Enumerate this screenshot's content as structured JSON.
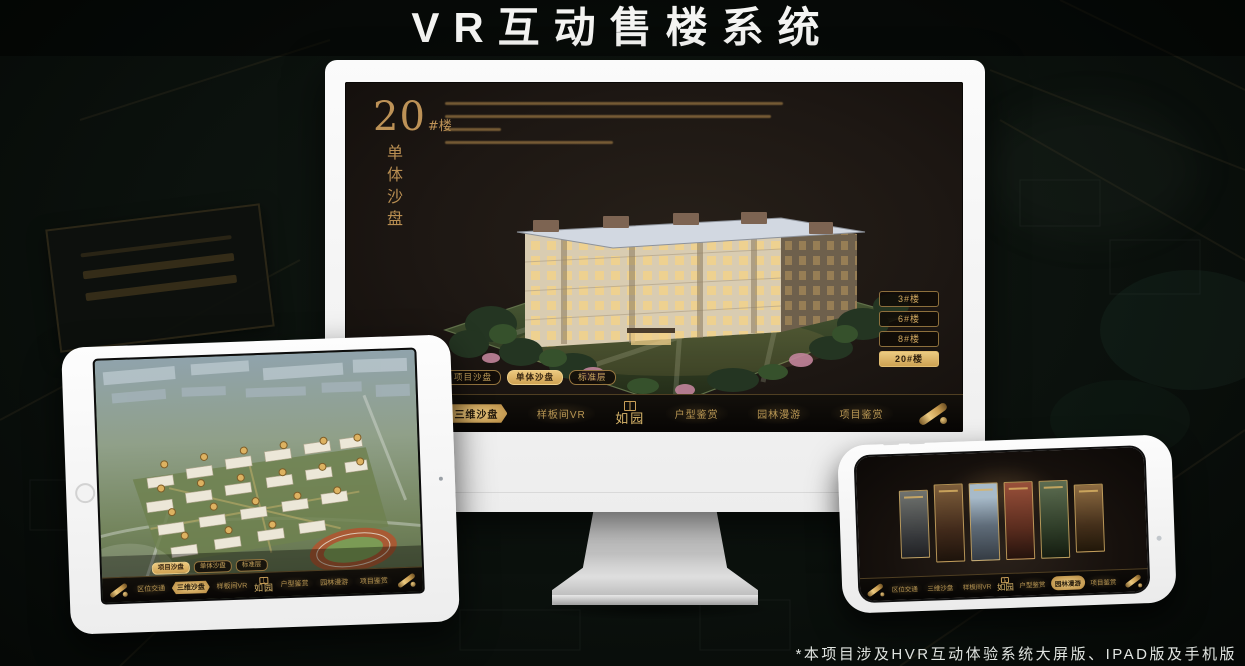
{
  "page": {
    "title": "VR互动售楼系统",
    "footnote": "*本项目涉及HVR互动体验系统大屏版、IPAD版及手机版"
  },
  "colors": {
    "gold_accent": "#c9a05c",
    "gold_selected": "#ecca81",
    "screen_background": "#1d1713",
    "page_background": "#0b110d"
  },
  "monitor": {
    "panel_title": {
      "number": "20",
      "suffix": "#楼",
      "vertical_label": "单体沙盘"
    },
    "building_buttons": [
      {
        "label": "3#楼",
        "selected": false
      },
      {
        "label": "6#楼",
        "selected": false
      },
      {
        "label": "8#楼",
        "selected": false
      },
      {
        "label": "20#楼",
        "selected": true
      }
    ],
    "sub_tabs": [
      {
        "label": "项目沙盘",
        "selected": false
      },
      {
        "label": "单体沙盘",
        "selected": true
      },
      {
        "label": "标准层",
        "selected": false
      }
    ],
    "menu": {
      "items": [
        {
          "label": "区位交通",
          "selected": false
        },
        {
          "label": "三维沙盘",
          "selected": true
        },
        {
          "label": "样板间VR",
          "selected": false
        },
        {
          "label": "如园",
          "type": "logo"
        },
        {
          "label": "户型鉴赏",
          "selected": false
        },
        {
          "label": "园林漫游",
          "selected": false
        },
        {
          "label": "项目鉴赏",
          "selected": false
        }
      ]
    }
  },
  "tablet": {
    "sub_tabs": [
      {
        "label": "项目沙盘",
        "selected": true
      },
      {
        "label": "单体沙盘",
        "selected": false
      },
      {
        "label": "标准层",
        "selected": false
      }
    ],
    "menu": {
      "items": [
        {
          "label": "区位交通",
          "selected": false
        },
        {
          "label": "三维沙盘",
          "selected": true
        },
        {
          "label": "样板间VR",
          "selected": false
        },
        {
          "label": "如园",
          "type": "logo"
        },
        {
          "label": "户型鉴赏",
          "selected": false
        },
        {
          "label": "园林漫游",
          "selected": false
        },
        {
          "label": "项目鉴赏",
          "selected": false
        }
      ]
    }
  },
  "phone": {
    "menu": {
      "items": [
        {
          "label": "区位交通",
          "selected": false
        },
        {
          "label": "三维沙盘",
          "selected": false
        },
        {
          "label": "样板间VR",
          "selected": false
        },
        {
          "label": "如园",
          "type": "logo"
        },
        {
          "label": "户型鉴赏",
          "selected": false
        },
        {
          "label": "园林漫游",
          "selected": true
        },
        {
          "label": "项目鉴赏",
          "selected": false
        }
      ]
    }
  }
}
